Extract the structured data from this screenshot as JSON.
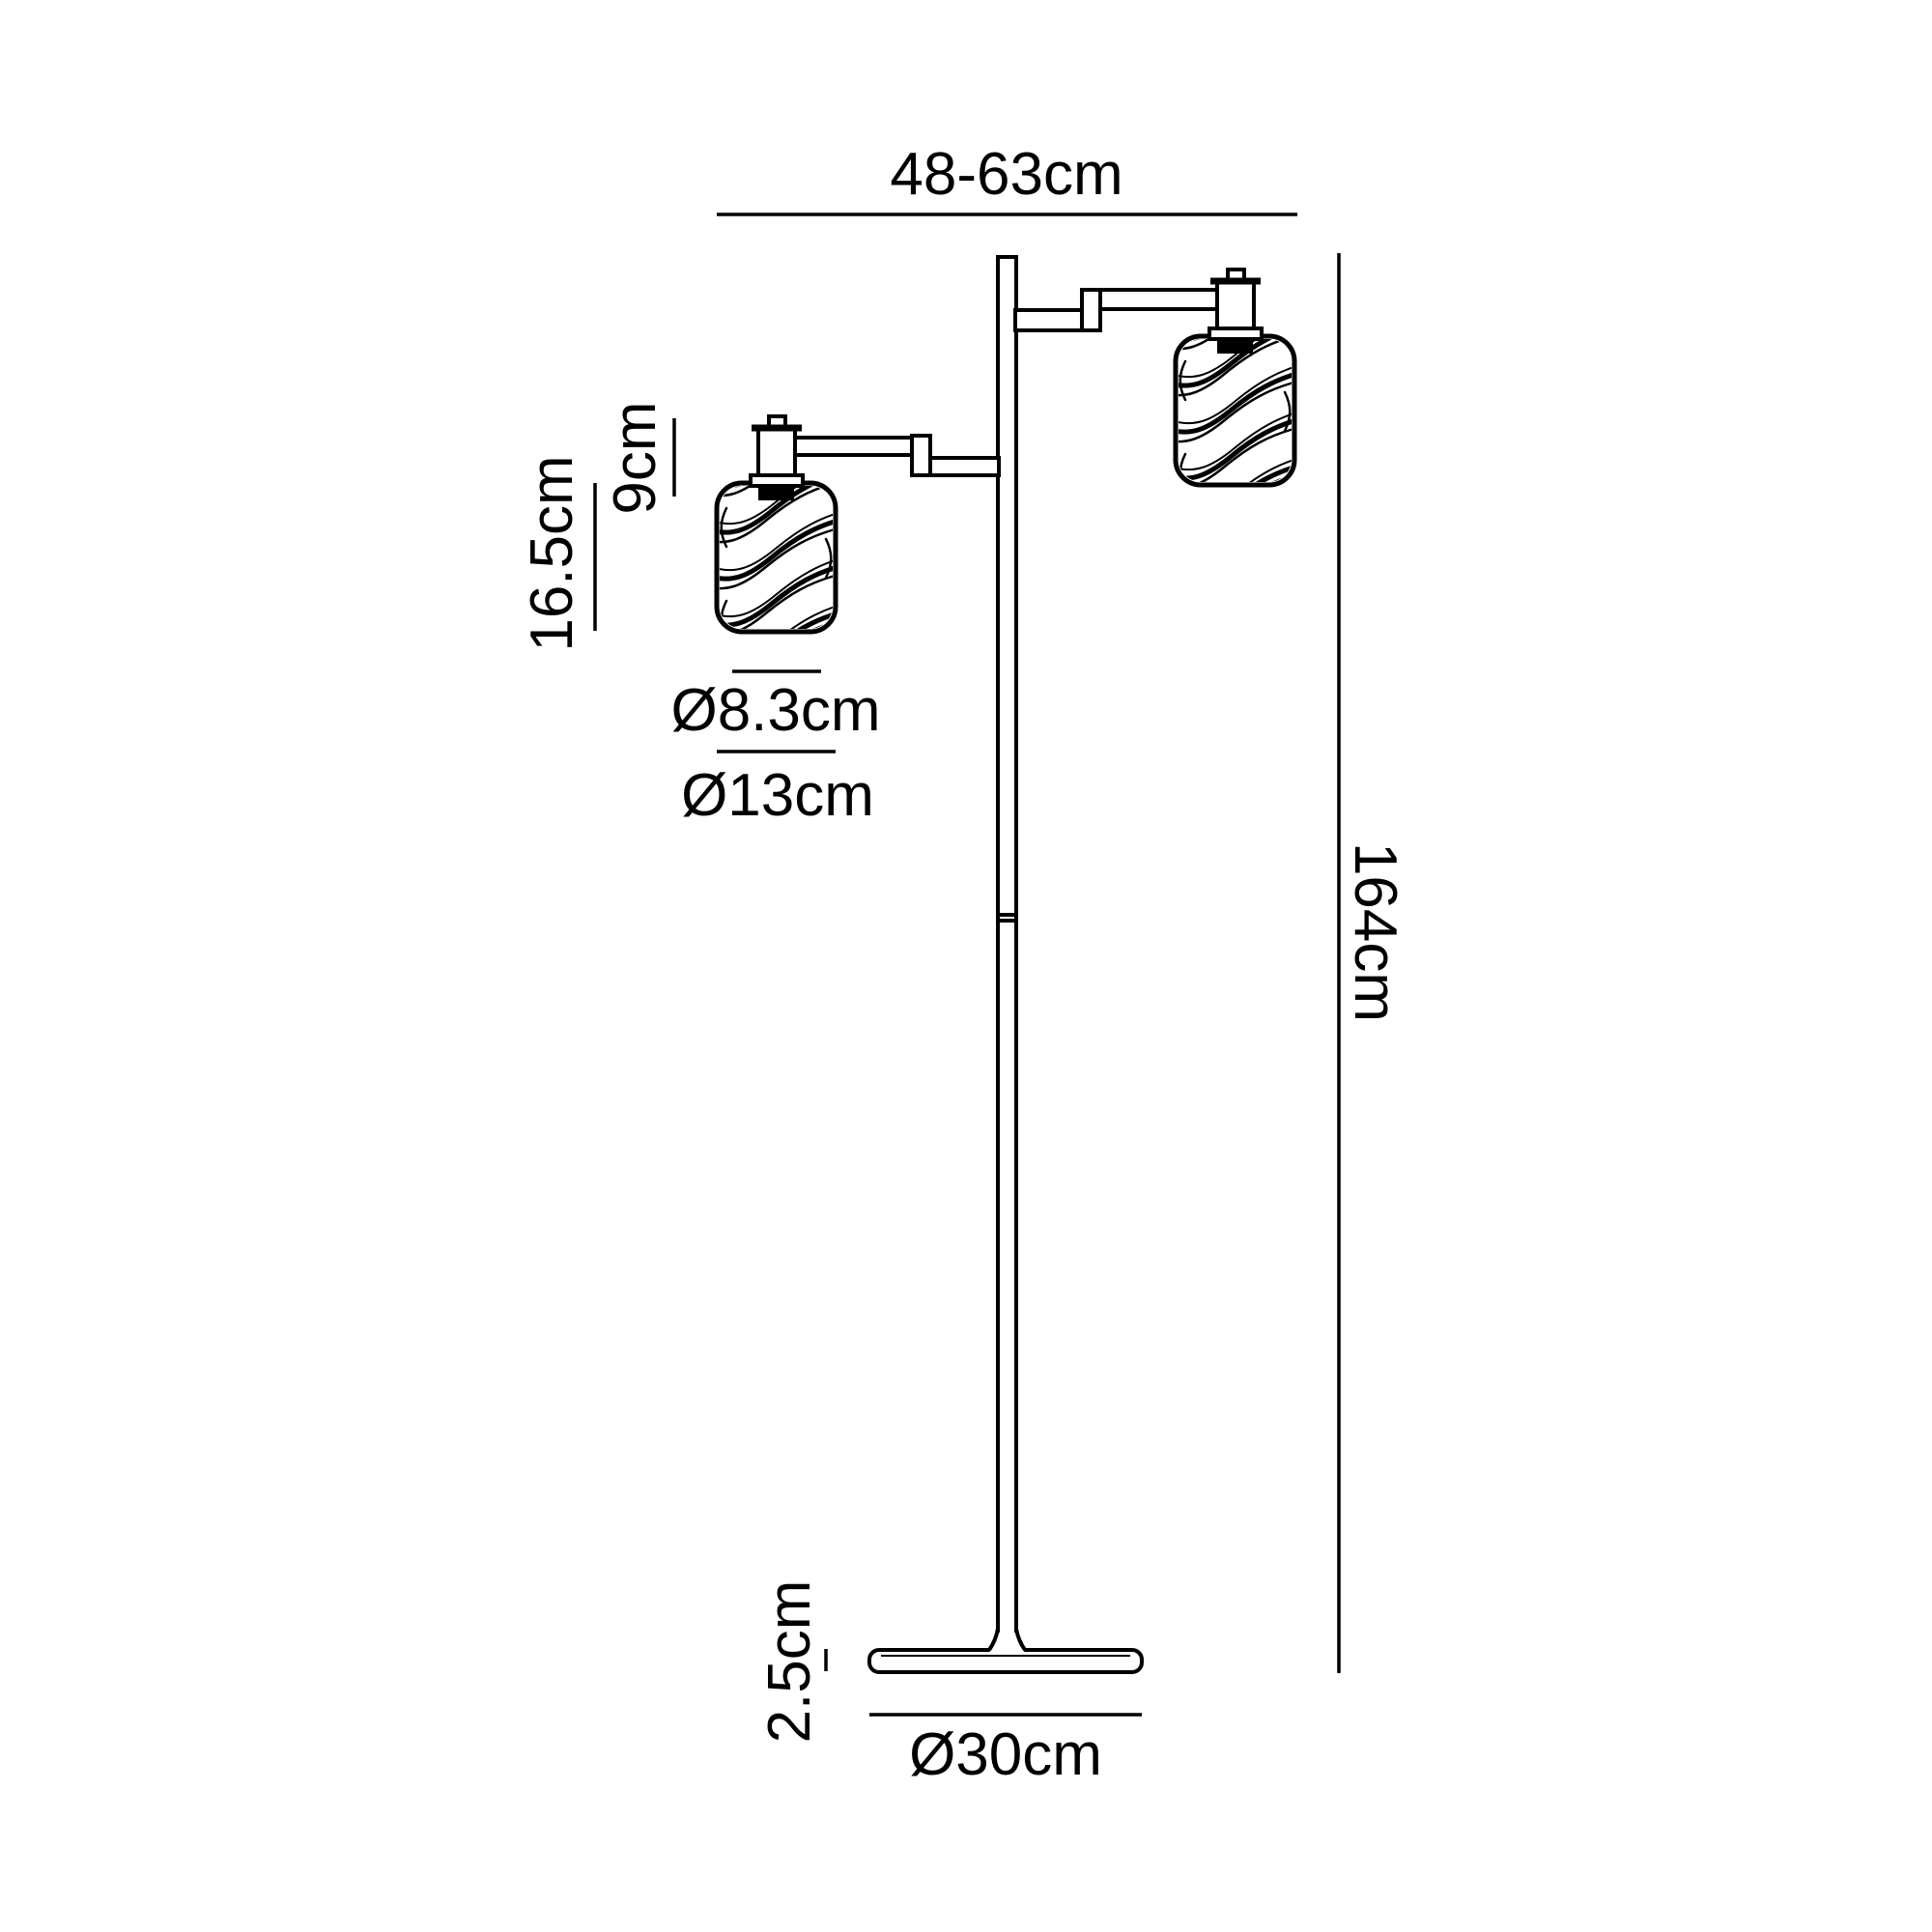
{
  "diagram": {
    "type": "floor-lamp-dimension-drawing",
    "colors": {
      "line": "#000000",
      "text": "#000000",
      "background": "#ffffff"
    },
    "labels": {
      "overall_width": "48-63cm",
      "overall_height": "164cm",
      "lampholder_height": "9cm",
      "shade_height": "16.5cm",
      "shade_top_diameter": "Ø8.3cm",
      "shade_diameter": "Ø13cm",
      "base_height": "2.5cm",
      "base_diameter": "Ø30cm"
    }
  }
}
